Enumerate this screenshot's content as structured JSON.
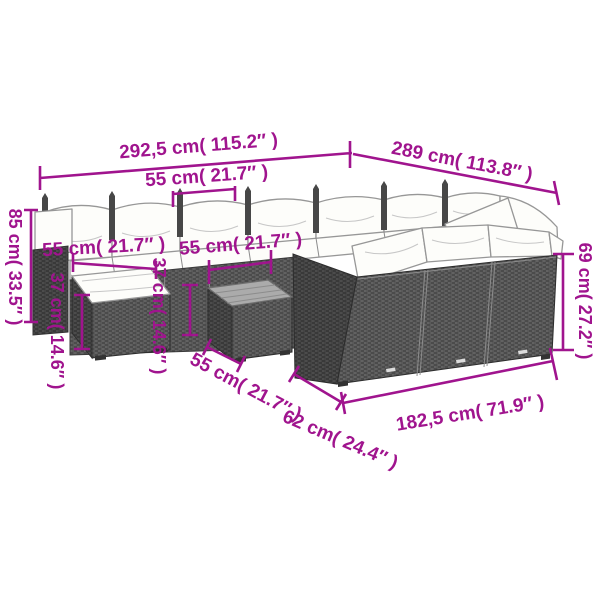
{
  "page": {
    "type": "product-dimension-diagram",
    "subject": "poly-rattan-garden-lounge-set",
    "background": "#ffffff",
    "accent_color": "#A0148E"
  },
  "labels": {
    "width_total": "292,5 cm( 115.2″ )",
    "depth_total": "289 cm( 113.8″ )",
    "seat_top": "55 cm( 21.7″ )",
    "height_back": "85 cm( 33.5″ )",
    "seat_left": "55 cm( 21.7″ )",
    "seat_mid": "55 cm( 21.7″ )",
    "height_stool": "37 cm( 14.6″ )",
    "height_table": "37 cm( 14.6″ )",
    "height_side": "69 cm( 27.2″ )",
    "table_width": "55 cm( 21.7″ )",
    "depth_corner": "62 cm( 24.4″ )",
    "length_front": "182,5 cm( 71.9″ )"
  }
}
